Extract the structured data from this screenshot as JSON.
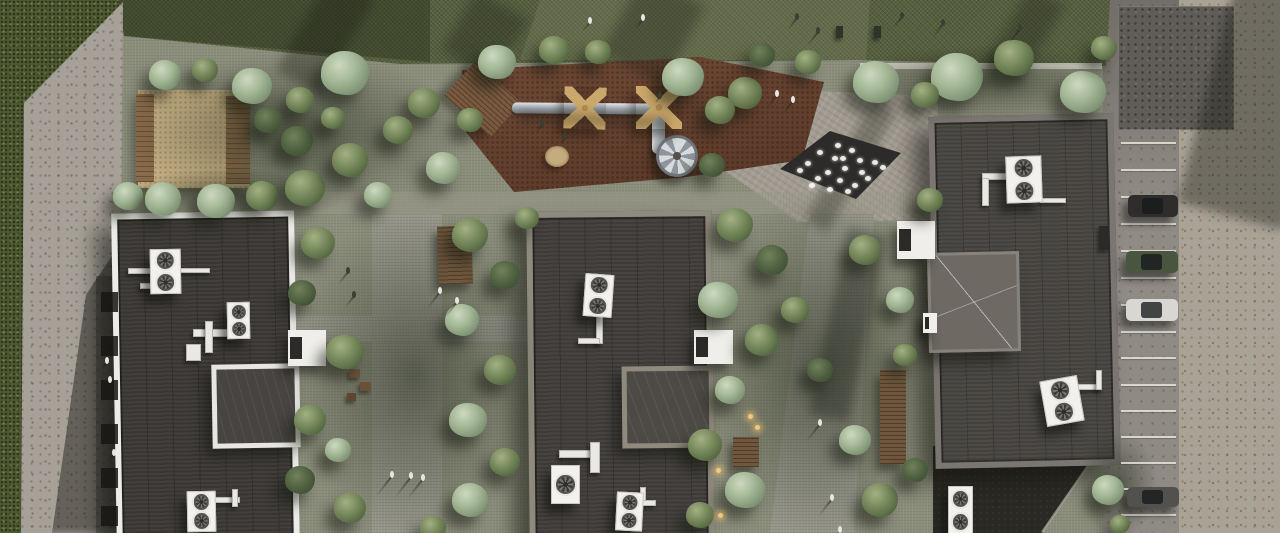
{
  "scene": {
    "description": "Aerial top-down 3D architectural rendering of a residential complex courtyard with three dark flat-roof buildings, rooftop HVAC units, landscaped courtyard with trees, playground with slide tube and canopies, sand pit, dry fountain plaza, pedestrian paths with people, and a parking strip with cars",
    "palette": {
      "courtyard": "#8b8d7b",
      "grass": "#4f5a33",
      "hedge": "#57603f",
      "concrete": "#a5a098",
      "roof_dark": "#403d3a",
      "parapet_white": "#ecebe7",
      "parapet_khaki": "#8f8a7d",
      "parapet_gray": "#7b7672",
      "mulch": "#6e4834",
      "sand": "#c8b287",
      "plaza": "#a29c91",
      "fountain": "#2d2b29",
      "tree_sage": "#a4b896",
      "tree_green": "#74875a",
      "asphalt": "#8f8b84"
    },
    "trees": [
      [
        252,
        86,
        20,
        "sage"
      ],
      [
        345,
        73,
        24,
        "sage"
      ],
      [
        300,
        100,
        14,
        "mid"
      ],
      [
        424,
        103,
        16,
        "mid"
      ],
      [
        497,
        62,
        19,
        "sage"
      ],
      [
        554,
        50,
        15,
        "mid"
      ],
      [
        598,
        52,
        13,
        "mid"
      ],
      [
        683,
        77,
        21,
        "sage"
      ],
      [
        745,
        93,
        17,
        "mid"
      ],
      [
        762,
        55,
        13,
        "dark"
      ],
      [
        808,
        62,
        13,
        "mid"
      ],
      [
        876,
        82,
        23,
        "sage"
      ],
      [
        957,
        77,
        26,
        "sage"
      ],
      [
        1014,
        58,
        20,
        "mid"
      ],
      [
        1083,
        92,
        23,
        "sage"
      ],
      [
        1104,
        48,
        13,
        "mid"
      ],
      [
        128,
        196,
        15,
        "sage"
      ],
      [
        163,
        199,
        18,
        "sage"
      ],
      [
        216,
        201,
        19,
        "sage"
      ],
      [
        262,
        196,
        16,
        "mid"
      ],
      [
        305,
        188,
        20,
        "mid"
      ],
      [
        165,
        75,
        16,
        "sage"
      ],
      [
        205,
        70,
        13,
        "mid"
      ],
      [
        268,
        120,
        14,
        "dark"
      ],
      [
        297,
        141,
        16,
        "dark"
      ],
      [
        350,
        160,
        18,
        "mid"
      ],
      [
        398,
        130,
        15,
        "mid"
      ],
      [
        443,
        168,
        17,
        "sage"
      ],
      [
        470,
        120,
        13,
        "mid"
      ],
      [
        378,
        195,
        14,
        "sage"
      ],
      [
        333,
        118,
        12,
        "mid"
      ],
      [
        318,
        243,
        17,
        "mid"
      ],
      [
        302,
        293,
        14,
        "dark"
      ],
      [
        345,
        352,
        19,
        "mid"
      ],
      [
        310,
        420,
        16,
        "mid"
      ],
      [
        300,
        480,
        15,
        "dark"
      ],
      [
        350,
        508,
        16,
        "mid"
      ],
      [
        338,
        450,
        13,
        "sage"
      ],
      [
        470,
        235,
        18,
        "mid"
      ],
      [
        505,
        275,
        15,
        "dark"
      ],
      [
        462,
        320,
        17,
        "sage"
      ],
      [
        500,
        370,
        16,
        "mid"
      ],
      [
        468,
        420,
        19,
        "sage"
      ],
      [
        505,
        462,
        15,
        "mid"
      ],
      [
        470,
        500,
        18,
        "sage"
      ],
      [
        433,
        528,
        13,
        "mid"
      ],
      [
        527,
        218,
        12,
        "mid"
      ],
      [
        720,
        110,
        15,
        "mid"
      ],
      [
        712,
        165,
        13,
        "dark"
      ],
      [
        735,
        225,
        18,
        "mid"
      ],
      [
        772,
        260,
        16,
        "dark"
      ],
      [
        718,
        300,
        20,
        "sage"
      ],
      [
        762,
        340,
        17,
        "mid"
      ],
      [
        730,
        390,
        15,
        "sage"
      ],
      [
        705,
        445,
        17,
        "mid"
      ],
      [
        745,
        490,
        20,
        "sage"
      ],
      [
        700,
        515,
        14,
        "mid"
      ],
      [
        795,
        310,
        14,
        "mid"
      ],
      [
        820,
        370,
        13,
        "dark"
      ],
      [
        865,
        250,
        16,
        "mid"
      ],
      [
        900,
        300,
        14,
        "sage"
      ],
      [
        905,
        355,
        12,
        "mid"
      ],
      [
        855,
        440,
        16,
        "sage"
      ],
      [
        880,
        500,
        18,
        "mid"
      ],
      [
        915,
        470,
        13,
        "dark"
      ],
      [
        930,
        200,
        13,
        "mid"
      ],
      [
        925,
        95,
        14,
        "mid"
      ],
      [
        1108,
        490,
        16,
        "sage"
      ],
      [
        1120,
        524,
        10,
        "mid"
      ]
    ],
    "groves": [
      [
        118,
        52,
        350,
        160
      ],
      [
        282,
        210,
        265,
        330
      ],
      [
        692,
        190,
        255,
        350
      ],
      [
        835,
        45,
        290,
        75
      ],
      [
        1078,
        430,
        80,
        108
      ],
      [
        118,
        168,
        230,
        55
      ]
    ],
    "shades": [
      [
        300,
        -20,
        50,
        110,
        30,
        0.35
      ],
      [
        618,
        -15,
        70,
        90,
        28,
        0.3
      ],
      [
        838,
        95,
        26,
        140,
        30,
        0.3
      ],
      [
        1005,
        -10,
        40,
        90,
        30,
        0.3
      ],
      [
        828,
        230,
        40,
        190,
        12,
        0.35
      ],
      [
        1205,
        -10,
        110,
        230,
        15,
        0.4
      ],
      [
        518,
        115,
        150,
        10,
        2,
        0.35
      ],
      [
        455,
        0,
        60,
        70,
        30,
        0.3
      ]
    ],
    "hvac_units": [
      [
        150,
        249,
        29,
        43,
        2,
        -1
      ],
      [
        227,
        302,
        21,
        35,
        2,
        -1
      ],
      [
        187,
        491,
        27,
        39,
        2,
        -1
      ],
      [
        584,
        274,
        27,
        41,
        2,
        4
      ],
      [
        551,
        465,
        27,
        37,
        1,
        0
      ],
      [
        616,
        492,
        25,
        37,
        2,
        3
      ],
      [
        1006,
        156,
        34,
        45,
        2,
        -2
      ],
      [
        1043,
        378,
        36,
        44,
        2,
        -10
      ],
      [
        948,
        486,
        23,
        47,
        2,
        0
      ]
    ],
    "pipes": [
      [
        128,
        268,
        26,
        4
      ],
      [
        140,
        283,
        22,
        4
      ],
      [
        178,
        268,
        30,
        3
      ],
      [
        193,
        329,
        36,
        6
      ],
      [
        205,
        321,
        6,
        30
      ],
      [
        186,
        344,
        13,
        15
      ],
      [
        212,
        497,
        26,
        4
      ],
      [
        232,
        489,
        4,
        16
      ],
      [
        596,
        316,
        5,
        26
      ],
      [
        578,
        338,
        20,
        4
      ],
      [
        559,
        450,
        34,
        6
      ],
      [
        590,
        442,
        8,
        29
      ],
      [
        640,
        487,
        4,
        16
      ],
      [
        640,
        500,
        14,
        4
      ],
      [
        982,
        173,
        26,
        5
      ],
      [
        982,
        178,
        5,
        26
      ],
      [
        1040,
        198,
        24,
        3
      ],
      [
        1078,
        384,
        22,
        4
      ],
      [
        1096,
        370,
        4,
        18
      ]
    ],
    "canopies": [
      [
        288,
        330,
        38,
        36
      ],
      [
        694,
        330,
        39,
        34
      ],
      [
        897,
        221,
        38,
        38
      ],
      [
        923,
        313,
        14,
        20
      ]
    ],
    "decks": [
      [
        438,
        226,
        34,
        58,
        -2
      ],
      [
        880,
        370,
        26,
        94,
        0
      ],
      [
        733,
        437,
        26,
        30,
        0
      ]
    ],
    "lamps": [
      [
        716,
        468
      ],
      [
        718,
        513
      ],
      [
        748,
        414
      ],
      [
        755,
        425
      ]
    ],
    "basement_windows": {
      "x": 101,
      "w": 17,
      "h": 20,
      "ys": [
        292,
        336,
        380,
        424,
        468,
        506
      ]
    },
    "parking": {
      "line_x": 1121,
      "line_w": 55,
      "line_ys": [
        142,
        169,
        196,
        223,
        250,
        277,
        304,
        331,
        357,
        384,
        410,
        436,
        462,
        488,
        514
      ],
      "cars": [
        [
          1128,
          195,
          50,
          22,
          "#2e2d2c"
        ],
        [
          1126,
          251,
          52,
          22,
          "#49553f"
        ],
        [
          1126,
          299,
          52,
          22,
          "#d9d7d2"
        ],
        [
          1127,
          487,
          52,
          20,
          "#53514e"
        ]
      ]
    },
    "fountain": {
      "clip": "polygon(830px 131px,901px 153px,856px 199px,780px 169px)",
      "jets": [
        [
          838,
          145
        ],
        [
          852,
          150
        ],
        [
          820,
          152
        ],
        [
          860,
          160
        ],
        [
          835,
          158
        ],
        [
          875,
          162
        ],
        [
          808,
          163
        ],
        [
          845,
          168
        ],
        [
          828,
          172
        ],
        [
          862,
          172
        ],
        [
          883,
          167
        ],
        [
          818,
          178
        ],
        [
          840,
          180
        ],
        [
          855,
          185
        ],
        [
          800,
          170
        ],
        [
          830,
          189
        ],
        [
          848,
          191
        ],
        [
          812,
          185
        ],
        [
          868,
          178
        ],
        [
          843,
          158
        ]
      ]
    },
    "props": [
      [
        836,
        26,
        7,
        12,
        "#2f342a"
      ],
      [
        874,
        26,
        7,
        12,
        "#2f342a"
      ],
      [
        1099,
        226,
        10,
        24,
        "#2c2a28"
      ],
      [
        349,
        369,
        11,
        9,
        "#6b5139"
      ],
      [
        360,
        382,
        11,
        9,
        "#6b5139"
      ],
      [
        347,
        393,
        9,
        8,
        "#5d462f"
      ],
      [
        568,
        462,
        10,
        8,
        "#3a382f"
      ]
    ],
    "people": [
      [
        795,
        13,
        "d",
        16
      ],
      [
        816,
        27,
        "d",
        18
      ],
      [
        900,
        12,
        "d",
        14
      ],
      [
        941,
        19,
        "d",
        16
      ],
      [
        1018,
        24,
        "d",
        18
      ],
      [
        588,
        17,
        "l",
        12
      ],
      [
        641,
        14,
        "l",
        12
      ],
      [
        775,
        90,
        "l",
        16
      ],
      [
        791,
        96,
        "l",
        16
      ],
      [
        438,
        287,
        "l",
        20
      ],
      [
        455,
        297,
        "l",
        20
      ],
      [
        346,
        267,
        "d",
        16
      ],
      [
        352,
        291,
        "d",
        14
      ],
      [
        390,
        471,
        "l",
        26
      ],
      [
        409,
        472,
        "l",
        26
      ],
      [
        421,
        474,
        "l",
        24
      ],
      [
        818,
        419,
        "l",
        22
      ],
      [
        830,
        494,
        "l",
        22
      ],
      [
        838,
        526,
        "l",
        8
      ],
      [
        105,
        357,
        "l",
        10
      ],
      [
        108,
        376,
        "l",
        9
      ],
      [
        112,
        449,
        "l",
        10
      ],
      [
        540,
        120,
        "d",
        8
      ],
      [
        563,
        133,
        "d",
        8
      ],
      [
        658,
        92,
        "d",
        8
      ]
    ]
  }
}
